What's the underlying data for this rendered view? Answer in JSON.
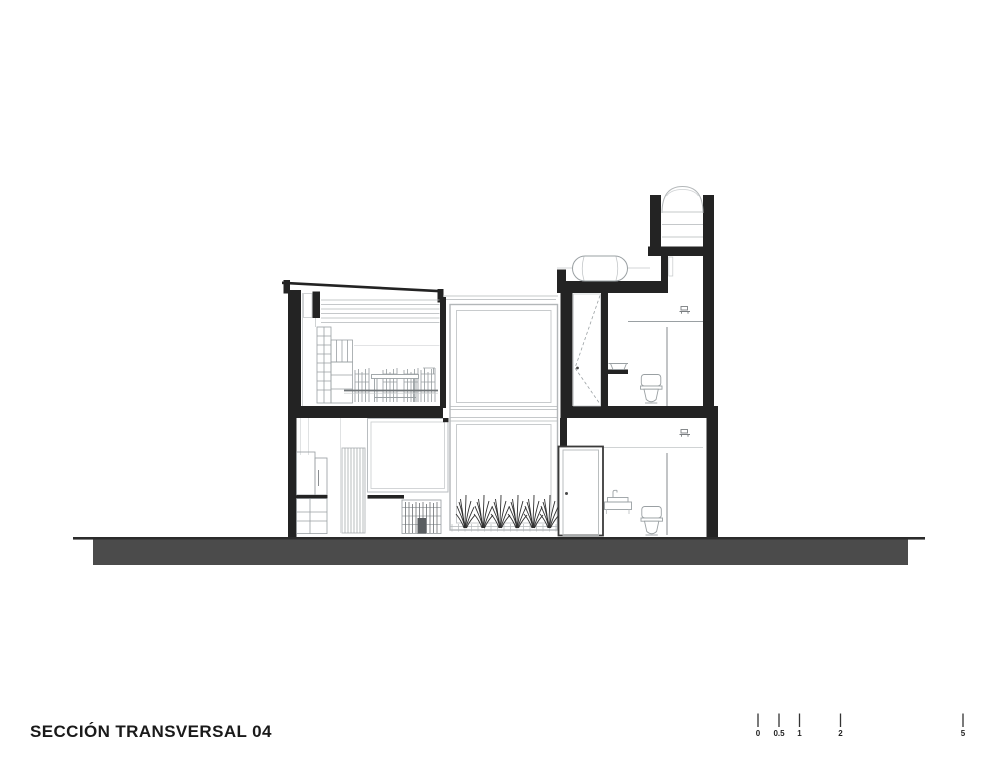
{
  "title": {
    "label": "SECCIÓN TRANSVERSAL 04"
  },
  "scale_bar": {
    "labels": [
      "0",
      "0.5",
      "1",
      "2",
      "5"
    ]
  },
  "colors": {
    "ink": "#232323",
    "ground_fill": "#4b4b4b",
    "light_line": "#b3b7b9",
    "mid_line": "#9aa0a3",
    "background": "#ffffff"
  },
  "drawing": {
    "type": "architectural-cross-section",
    "fixtures": [
      "water-tank",
      "boiler",
      "toilet",
      "sink",
      "door",
      "plants",
      "dining-table",
      "kitchen-cabinets",
      "ceiling-lamp"
    ]
  }
}
